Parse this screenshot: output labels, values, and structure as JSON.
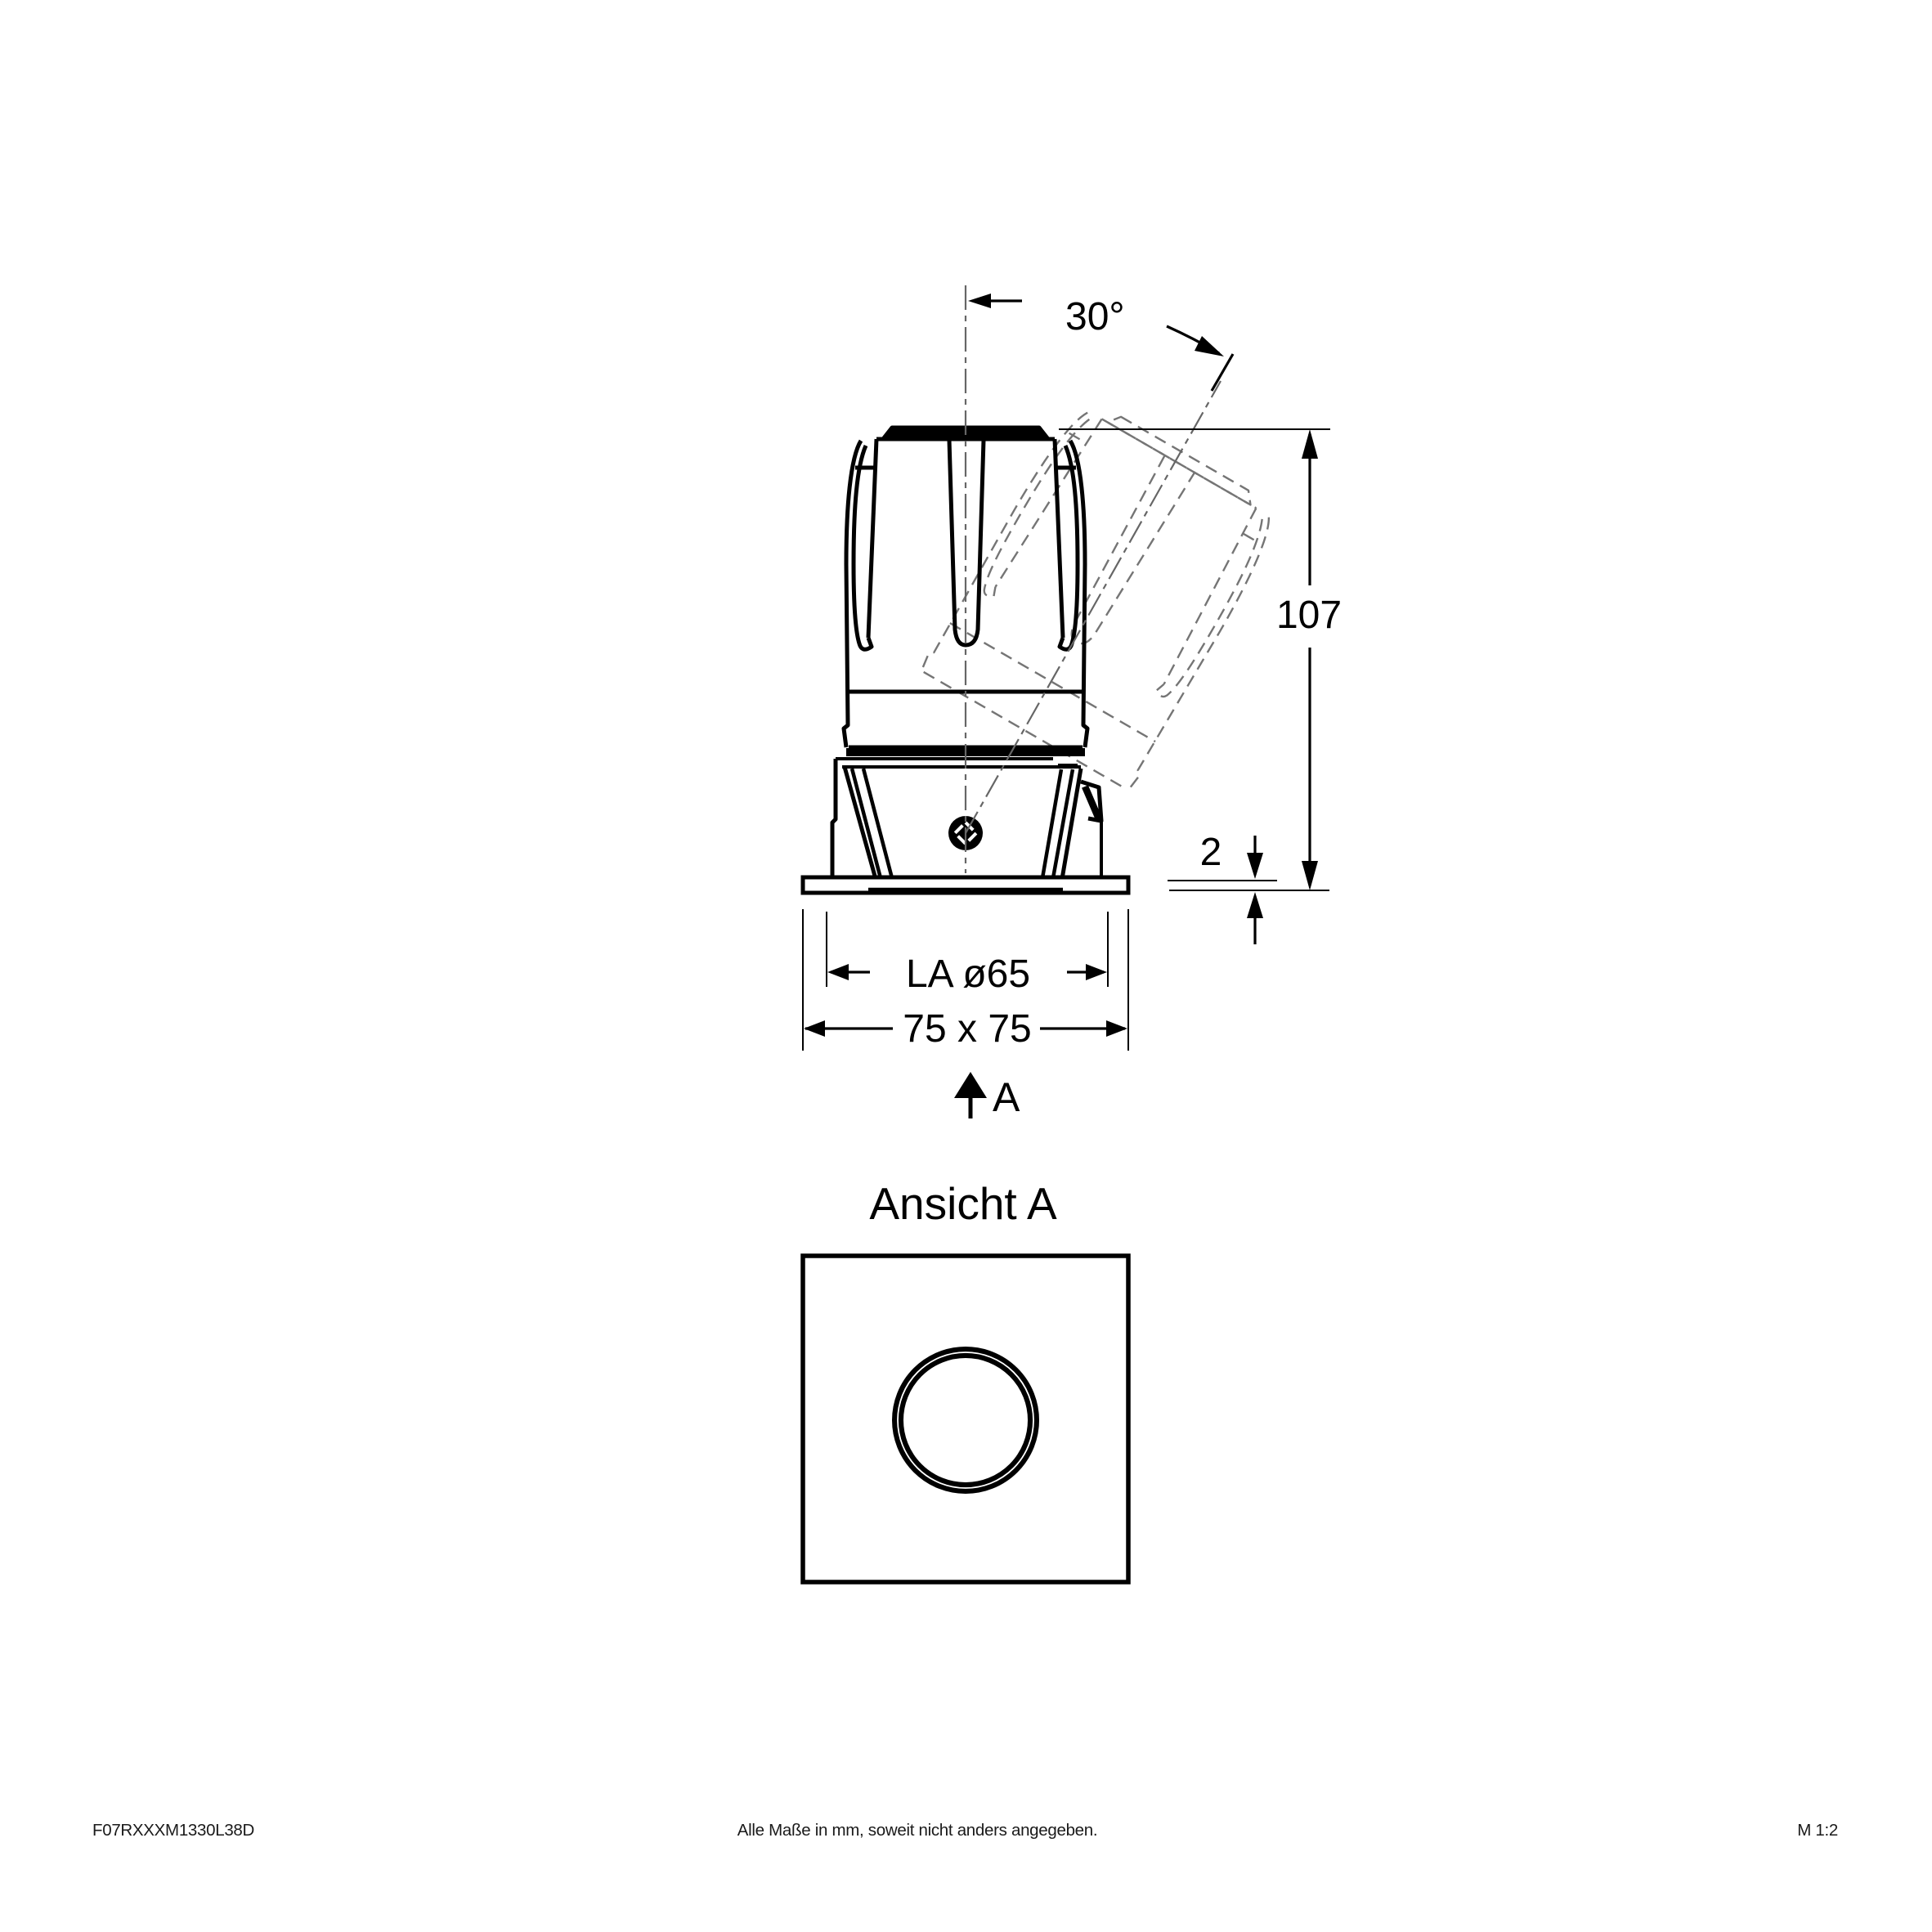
{
  "side_view": {
    "tilt_angle_label": "30°",
    "height_label": "107",
    "flange_thickness_label": "2",
    "cutout_label": "LA ø65",
    "frame_label": "75 x 75",
    "view_arrow_label": "A"
  },
  "bottom_view": {
    "title": "Ansicht A"
  },
  "footer": {
    "article_number": "F07RXXXM1330L38D",
    "note": "Alle Maße in mm, soweit nicht anders angegeben.",
    "scale": "M 1:2"
  },
  "colors": {
    "line": "#000000",
    "ghost_line": "#757575",
    "centerline": "#666666",
    "background": "#ffffff"
  }
}
